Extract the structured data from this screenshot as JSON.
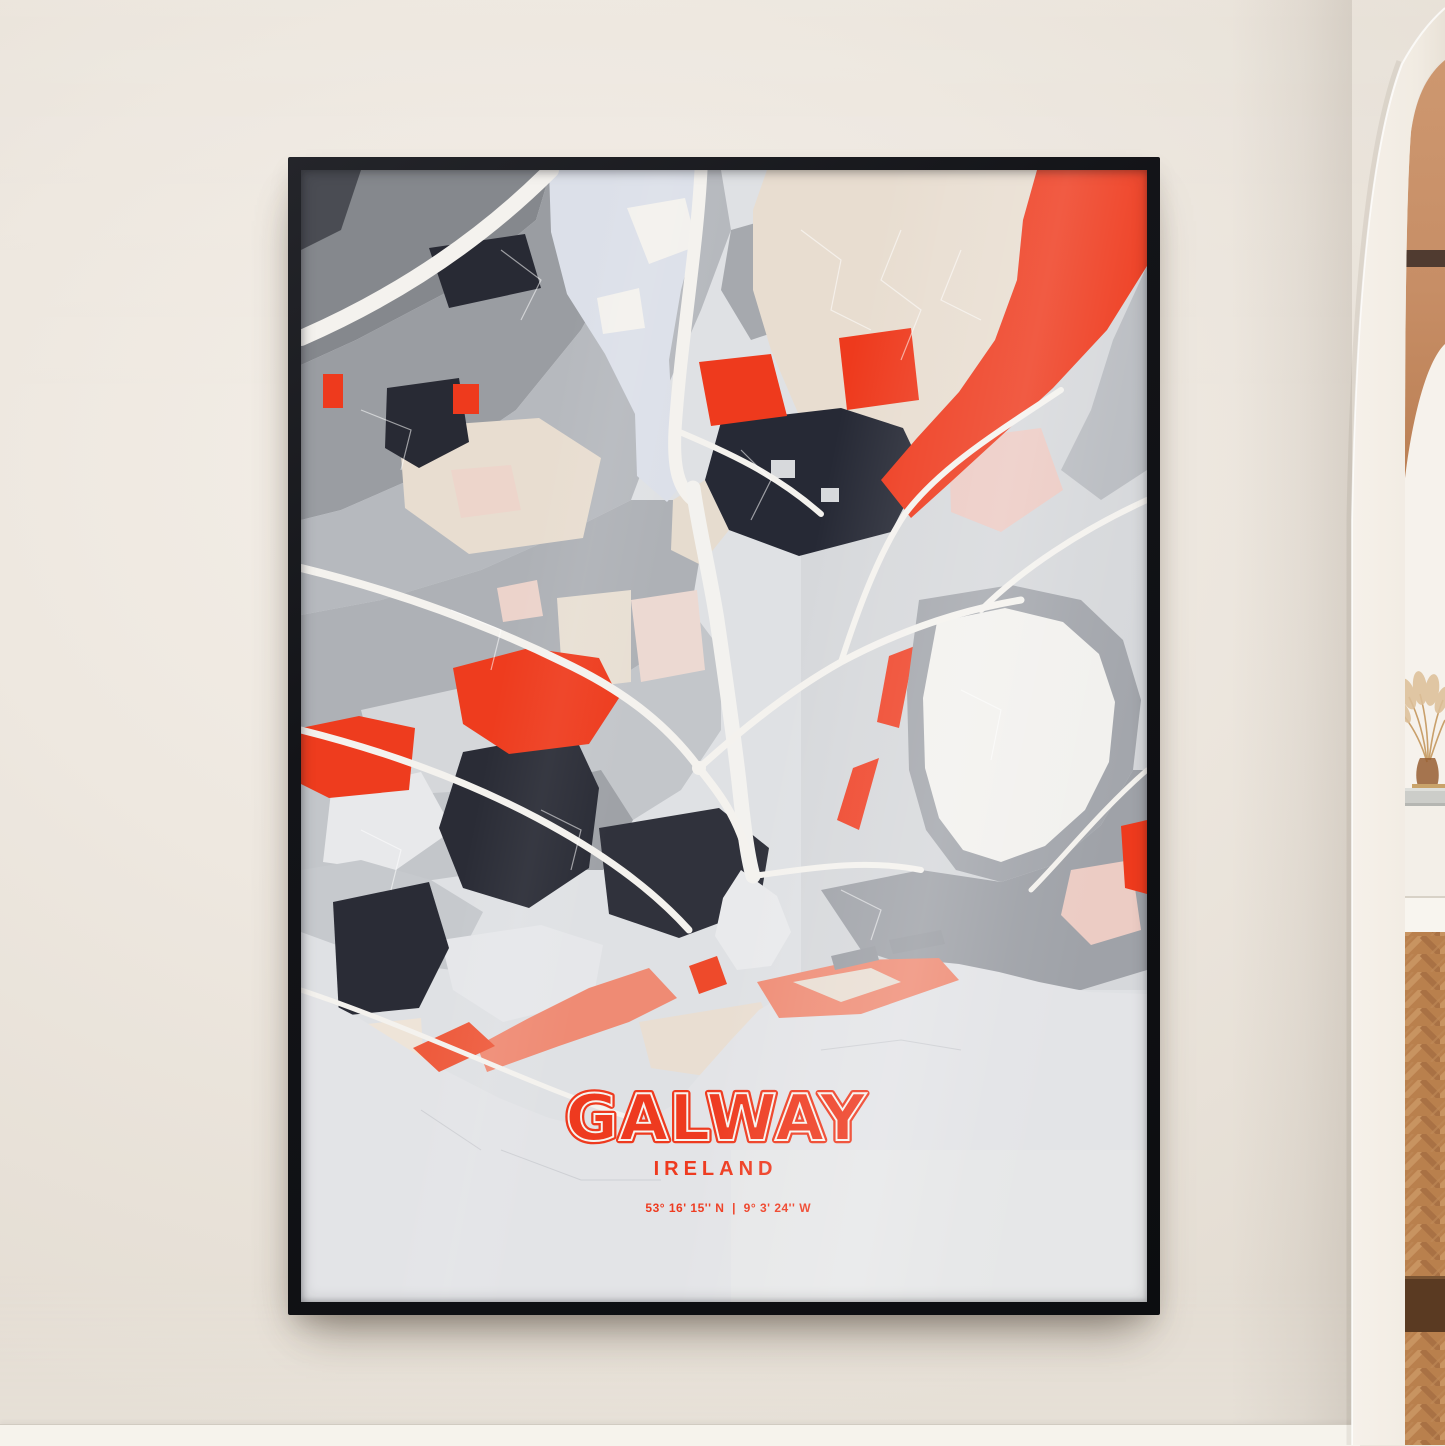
{
  "poster": {
    "title": "GALWAY",
    "country": "IRELAND",
    "coordinates": "53° 16' 15'' N  |  9° 3' 24'' W"
  },
  "palette": {
    "accent_red": "#ee3a1f",
    "map_red": "#ee3a1d",
    "salmon": "#ef8b74",
    "navy": "#262935",
    "beige": "#e8ddd0",
    "pink": "#ecd3cb",
    "water": "#dce0e9",
    "bay": "#e3e4e7",
    "road_white": "#f4f2ee",
    "frame_black": "#141518",
    "wall": "#ece6dd",
    "terracotta": "#c78e66",
    "wood": "#b9804d"
  }
}
